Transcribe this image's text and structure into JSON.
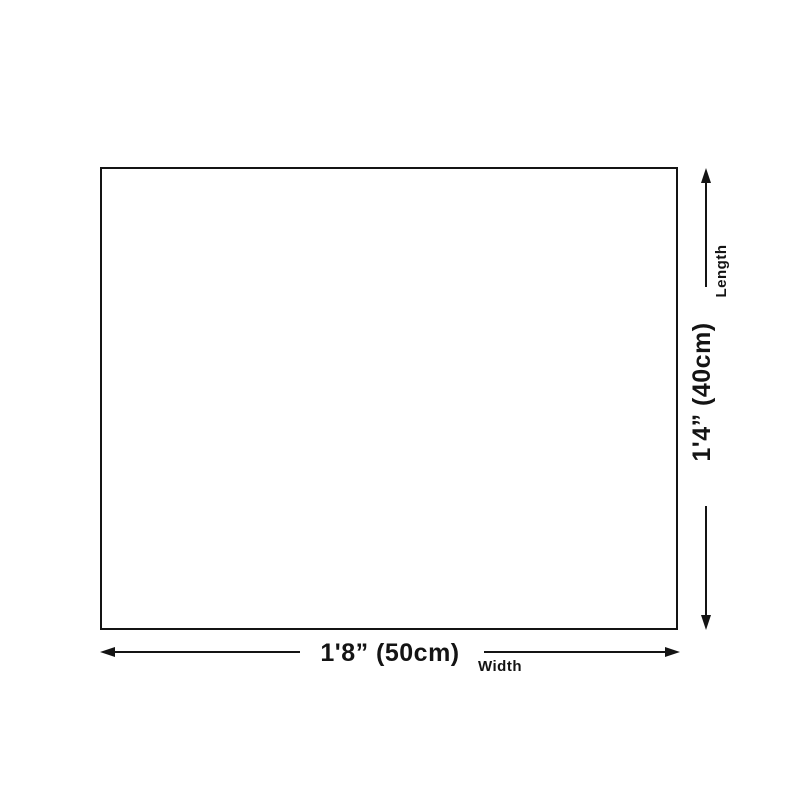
{
  "diagram": {
    "width": {
      "value": "1'8” (50cm)",
      "label": "Width"
    },
    "length": {
      "value": "1'4” (40cm)",
      "label": "Length"
    },
    "colors": {
      "line": "#141414",
      "text": "#141414",
      "background": "#ffffff",
      "box_fill": "#ffffff"
    }
  }
}
